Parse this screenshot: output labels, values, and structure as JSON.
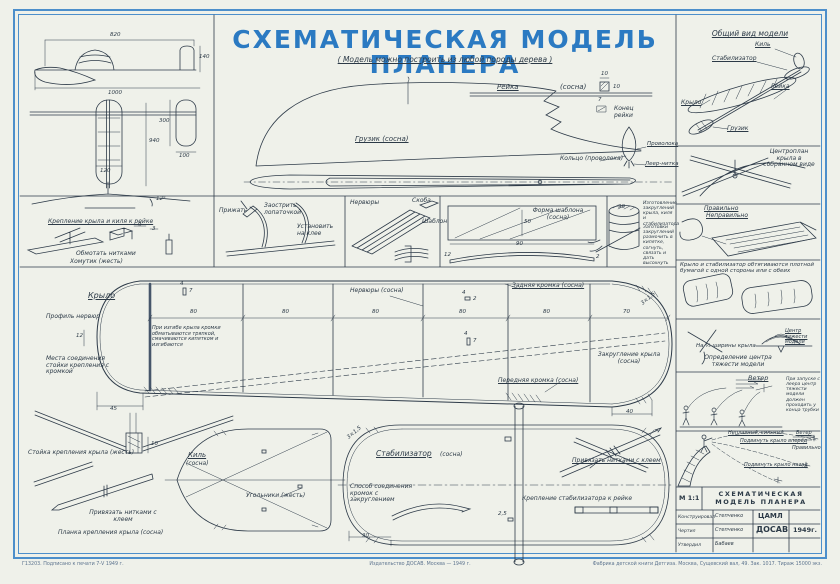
{
  "colors": {
    "frame": "#4d8fcb",
    "title_blue": "#2b7ac2",
    "ink": "#2c3a47",
    "paper": "#eff1ea"
  },
  "header": {
    "title": "СХЕМАТИЧЕСКАЯ МОДЕЛЬ ПЛАНЕРА",
    "subtitle": "( Модель можно построить из любой породы дерева )"
  },
  "three_view": {
    "d820": "820",
    "d1000": "1000",
    "d140": "140",
    "d940": "940",
    "d120": "120",
    "d300": "300",
    "d100": "100",
    "angle": "12°"
  },
  "attach": {
    "caption": "Крепление крыла и киля к рейке",
    "wrap": "Обмотать нитками",
    "clamp": "Хомутик (жесть)",
    "d9": "9",
    "d3": "3"
  },
  "fuselage": {
    "weight": "Грузик (сосна)",
    "rail": "Рейка",
    "rail_mat": "(сосна)",
    "d10a": "10",
    "d10b": "10",
    "d7": "7",
    "rail_end": "Конец рейки",
    "ring": "Кольцо (проволока)",
    "wire": "Проволока",
    "towline": "Леер-нитка"
  },
  "strip": {
    "press": "Прижать",
    "sharpen": "Заострить лопаточкой",
    "glue": "Установить на клее",
    "ribs": "Нервюры",
    "brace": "Скоба",
    "template": "Шаблон",
    "tpl_shape": "Форма шаблона (сосна)",
    "d50": "50",
    "d90t": "90",
    "d12": "12",
    "d2": "2",
    "rounding_title": "Изготовление закруглений крыла, киля и стабилизатора",
    "rounding_text": "Заготовки закруглений размочить в кипятке, согнуть, связать и дать высохнуть",
    "d90": "90"
  },
  "wing": {
    "name": "Крыло",
    "profile": "Профиль нервюр",
    "d12": "12",
    "joint": "Места соединения стойки крепления с кромкой",
    "bend": "При изгибе крыла кромки обматываются тряпкой, смачиваются кипятком и изгибаются",
    "ribs": "Нервюры (сосна)",
    "rear": "Задняя кромка (сосна)",
    "front": "Передняя кромка (сосна)",
    "round": "Закругление крыла (сосна)",
    "sec": "3×1,5",
    "d45": "45",
    "d80": "80",
    "d70": "70",
    "d40": "40",
    "d4": "4",
    "d7": "7",
    "d2": "2"
  },
  "dihedral": {
    "d10": "10",
    "post": "Стойка крепления крыла (жесть)",
    "tie": "Привязать нитками с клеем",
    "plank": "Планка крепления крыла (сосна)"
  },
  "fin": {
    "name": "Киль",
    "mat": "(сосна)",
    "corners": "Угольники (жесть)"
  },
  "stab": {
    "name": "Стабилизатор",
    "mat": "(сосна)",
    "sec": "3×1,5",
    "join": "Способ соединения кромок с закруглением",
    "d30": "30",
    "d25": "2,5",
    "tie": "Привязать нитками с клеем",
    "attach": "Крепление стабилизатора к рейке"
  },
  "panel1": {
    "title": "Общий вид модели",
    "fin": "Киль",
    "stab": "Стабилизатор",
    "rail": "Рейка",
    "wing": "Крыло",
    "weight": "Грузик"
  },
  "panel2": {
    "caption": "Центроплан крыла в собранном виде"
  },
  "panel3": {
    "ok": "Правильно",
    "bad": "Неправильно"
  },
  "panel4": {
    "text": "Крыло и стабилизатор обтягиваются плотной бумагой с одной стороны или с обеих"
  },
  "panel5": {
    "third": "На ⅓ ширины крыла",
    "caption": "Определение центра тяжести модели",
    "cg": "Центр тяжести модели"
  },
  "panel6": {
    "wind": "Ветер",
    "note": "При запуске с леера центр тяжести модели должен проходить у конца трубки"
  },
  "panel7": {
    "bad": "Неплавный, сильный",
    "fix1": "Подвинуть крыло вперёд",
    "wind": "Ветер",
    "ok": "Правильно",
    "fix2": "Подвинуть крыло назад"
  },
  "title_block": {
    "scale": "М 1:1",
    "line1": "СХЕМАТИЧЕСКАЯ",
    "line2": "МОДЕЛЬ ПЛАНЕРА",
    "r1l": "Конструировал",
    "r1v": "Степченко",
    "r2l": "Чертил",
    "r2v": "Степченко",
    "r3l": "Утвердил",
    "r3v": "Бабаев",
    "org1": "ЦАМЛ",
    "org2": "ДОСАВ",
    "year": "1949г."
  },
  "footer": {
    "left": "Г13203. Подписано к печати 7-V 1949 г.",
    "center": "Издательство ДОСАВ. Москва — 1949 г.",
    "right": "Фабрика детской книги Детгиза. Москва, Сущевский вал, 49. Зак. 1017. Тираж 15000 экз."
  }
}
